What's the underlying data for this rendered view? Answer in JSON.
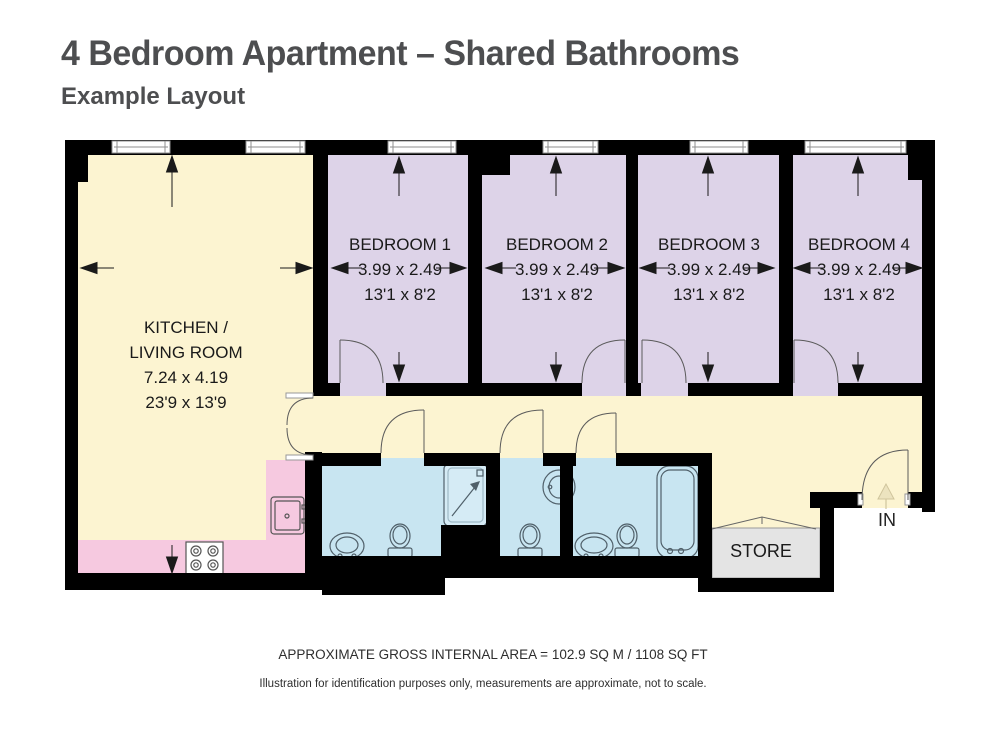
{
  "header": {
    "title": "4 Bedroom Apartment – Shared Bathrooms",
    "subtitle": "Example Layout"
  },
  "rooms": {
    "kitchen_living": {
      "name_line1": "KITCHEN /",
      "name_line2": "LIVING ROOM",
      "metric_dims": "7.24 x 4.19",
      "imperial_dims": "23'9 x 13'9"
    },
    "bedroom1": {
      "name": "BEDROOM 1",
      "metric_dims": "3.99 x 2.49",
      "imperial_dims": "13'1 x 8'2"
    },
    "bedroom2": {
      "name": "BEDROOM 2",
      "metric_dims": "3.99 x 2.49",
      "imperial_dims": "13'1 x 8'2"
    },
    "bedroom3": {
      "name": "BEDROOM 3",
      "metric_dims": "3.99 x 2.49",
      "imperial_dims": "13'1 x 8'2"
    },
    "bedroom4": {
      "name": "BEDROOM 4",
      "metric_dims": "3.99 x 2.49",
      "imperial_dims": "13'1 x 8'2"
    },
    "store": {
      "name": "STORE"
    }
  },
  "entrance": {
    "label": "IN"
  },
  "footer": {
    "area_text": "APPROXIMATE GROSS INTERNAL AREA = 102.9 SQ M / 1108 SQ FT",
    "disclaimer": "Illustration for identification purposes only, measurements are approximate, not to scale."
  },
  "colors": {
    "wall": "#000000",
    "kitchen_floor": "#FCF4D1",
    "bedroom_floor": "#DDD3E8",
    "bathroom_floor": "#C8E5F1",
    "counter": "#F6C9E0",
    "store_floor": "#E4E4E4",
    "shower_tray": "#D5EBF5",
    "title_text": "#4D4E50"
  }
}
